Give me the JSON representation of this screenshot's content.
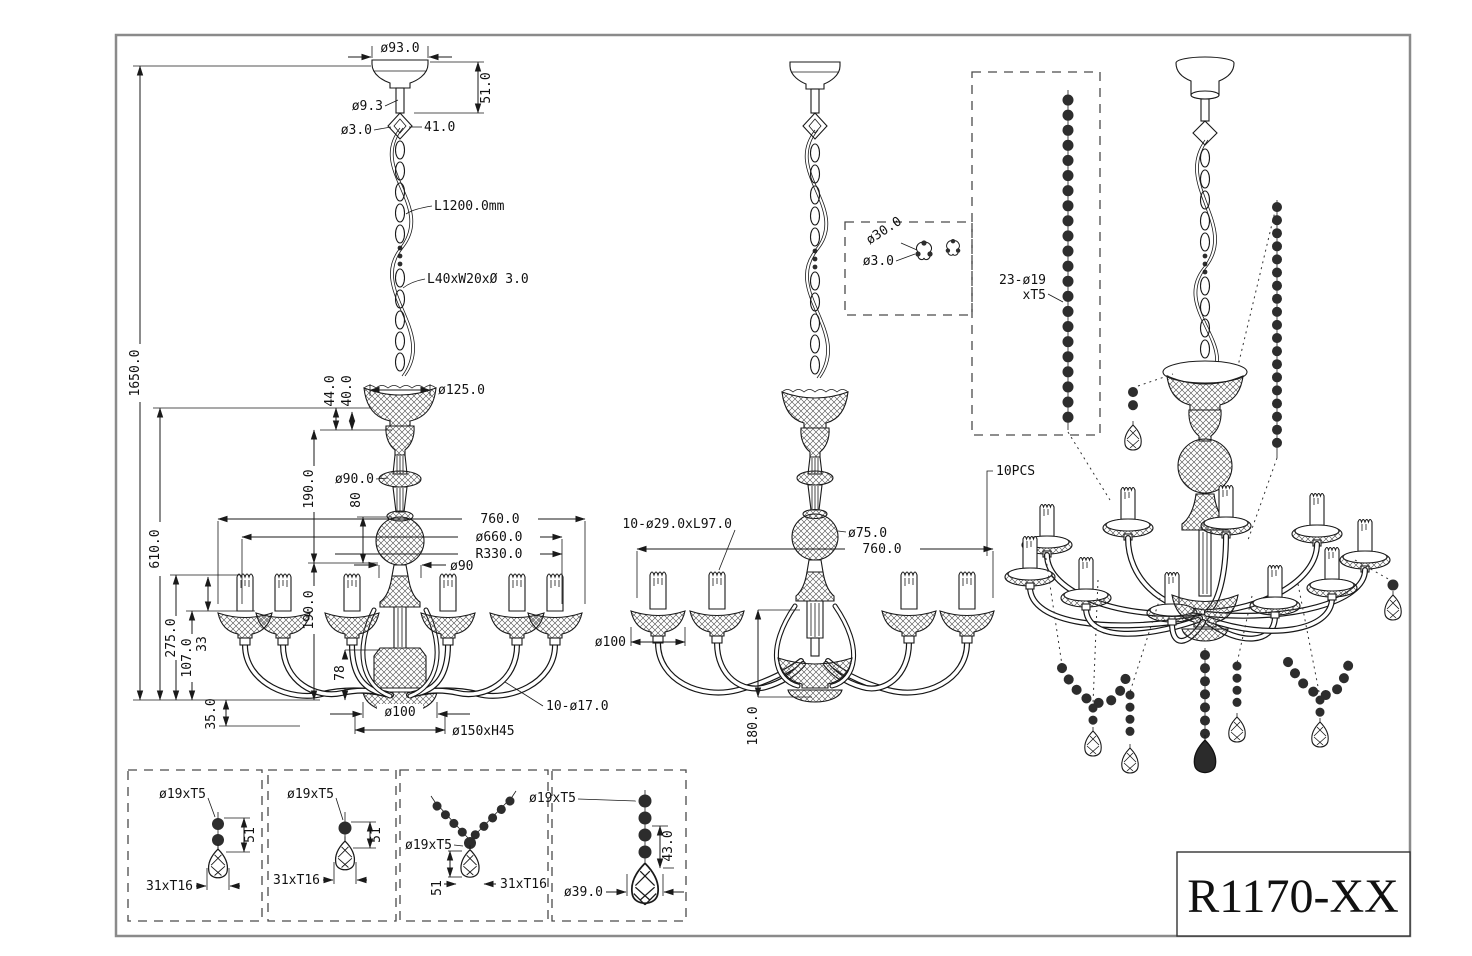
{
  "title": {
    "model": "R1170-XX"
  },
  "front": {
    "canopy_dia": "ø93.0",
    "canopy_h": "51.0",
    "stem_dia": "ø9.3",
    "cord_dia": "ø3.0",
    "loop_w": "41.0",
    "chain_len": "L1200.0mm",
    "chain_link": "L40xW20xØ 3.0",
    "total_h": "1650.0",
    "body_h": "610.0",
    "d44": "44.0",
    "d40": "40.0",
    "bowl_dia": "ø125.0",
    "col_h": "190.0",
    "col_dia": "ø90.0",
    "ball_h": "80",
    "width": "760.0",
    "arm_dia": "ø660.0",
    "arm_r": "R330.0",
    "hub_dia": "ø90",
    "lower_h": "190.0",
    "d275": "275.0",
    "d107": "107.0",
    "d33": "33",
    "d78": "78",
    "d35": "35.0",
    "bottom_dia": "ø100",
    "finial": "ø150xH45",
    "candles": "10-ø17.0"
  },
  "side": {
    "arm_spec": "10-ø29.0xL97.0",
    "ball_dia": "ø75.0",
    "width": "760.0",
    "bobeche_dia": "ø100",
    "bottom_h": "180.0",
    "pcs": "10PCS",
    "link_outer": "ø30.0",
    "link_wire": "ø3.0",
    "strand1": "23-ø19",
    "strand2": "xT5"
  },
  "d1": {
    "bead": "ø19xT5",
    "h": "51",
    "w": "31xT16"
  },
  "d2": {
    "bead": "ø19xT5",
    "h": "51",
    "w": "31xT16"
  },
  "d3": {
    "bead": "ø19xT5",
    "h": "51",
    "w": "31xT16"
  },
  "d4": {
    "bead": "ø19xT5",
    "h": "43.0",
    "w": "ø39.0"
  }
}
